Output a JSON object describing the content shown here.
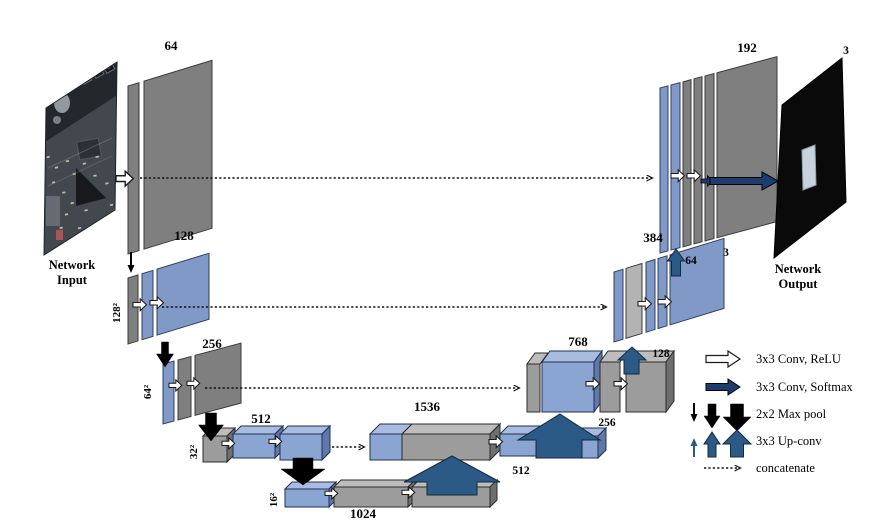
{
  "diagram": {
    "input": {
      "label_line1": "Network",
      "label_line2": "Input"
    },
    "output": {
      "label_line1": "Network",
      "label_line2": "Output",
      "channels": "3"
    },
    "encoder": {
      "row1_channels": "64",
      "row2_channels": "128",
      "row2_size": "128²",
      "row3_channels": "256",
      "row3_size": "64²",
      "row4_channels": "512",
      "row4_size": "32²",
      "row5_channels": "1024",
      "row5_size": "16²"
    },
    "decoder": {
      "row1_channels": "192",
      "row2_channels": "384",
      "row2_out": "3",
      "row3_channels": "768",
      "row4_channels": "1536"
    },
    "upconv_channels": {
      "to_row1": "64",
      "to_row2": "128",
      "to_row3": "256",
      "to_row4": "512"
    },
    "legend": {
      "conv_relu": "3x3 Conv, ReLU",
      "conv_softmax": "3x3 Conv, Softmax",
      "max_pool": "2x2 Max pool",
      "up_conv": "3x3 Up-conv",
      "concat": "concatenate"
    },
    "colors": {
      "feature_gray": "#7f7f7f",
      "feature_blue": "#8099c7",
      "softmax_arrow": "#1e3c6e",
      "upconv_arrow": "#2a5a85",
      "maxpool_arrow": "#000000",
      "conv_arrow": "#ffffff"
    }
  }
}
